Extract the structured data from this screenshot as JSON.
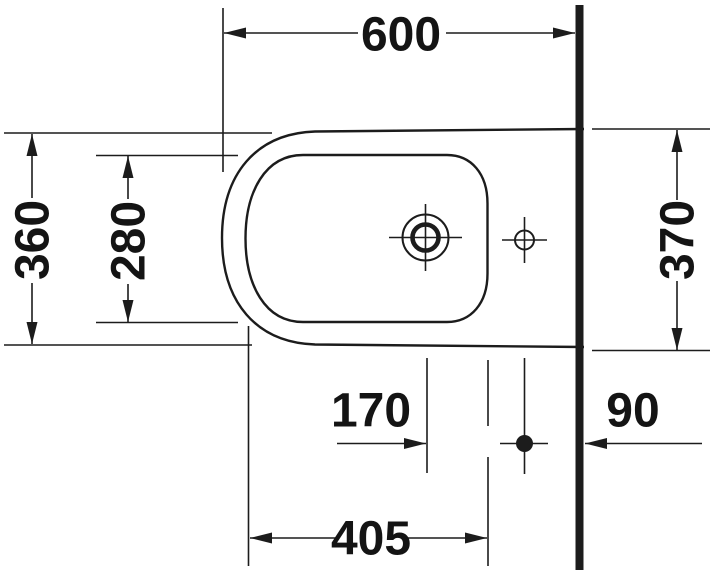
{
  "drawing": {
    "title": "bidet-top-view-dimension-drawing",
    "ink_color": "#1c1c1c",
    "background_color": "#ffffff"
  },
  "dimensions": {
    "overall_length": "600",
    "front_width": "360",
    "basin_width": "280",
    "wall_width": "370",
    "drain_to_hole": "170",
    "hole_to_wall": "90",
    "basin_length": "405"
  }
}
